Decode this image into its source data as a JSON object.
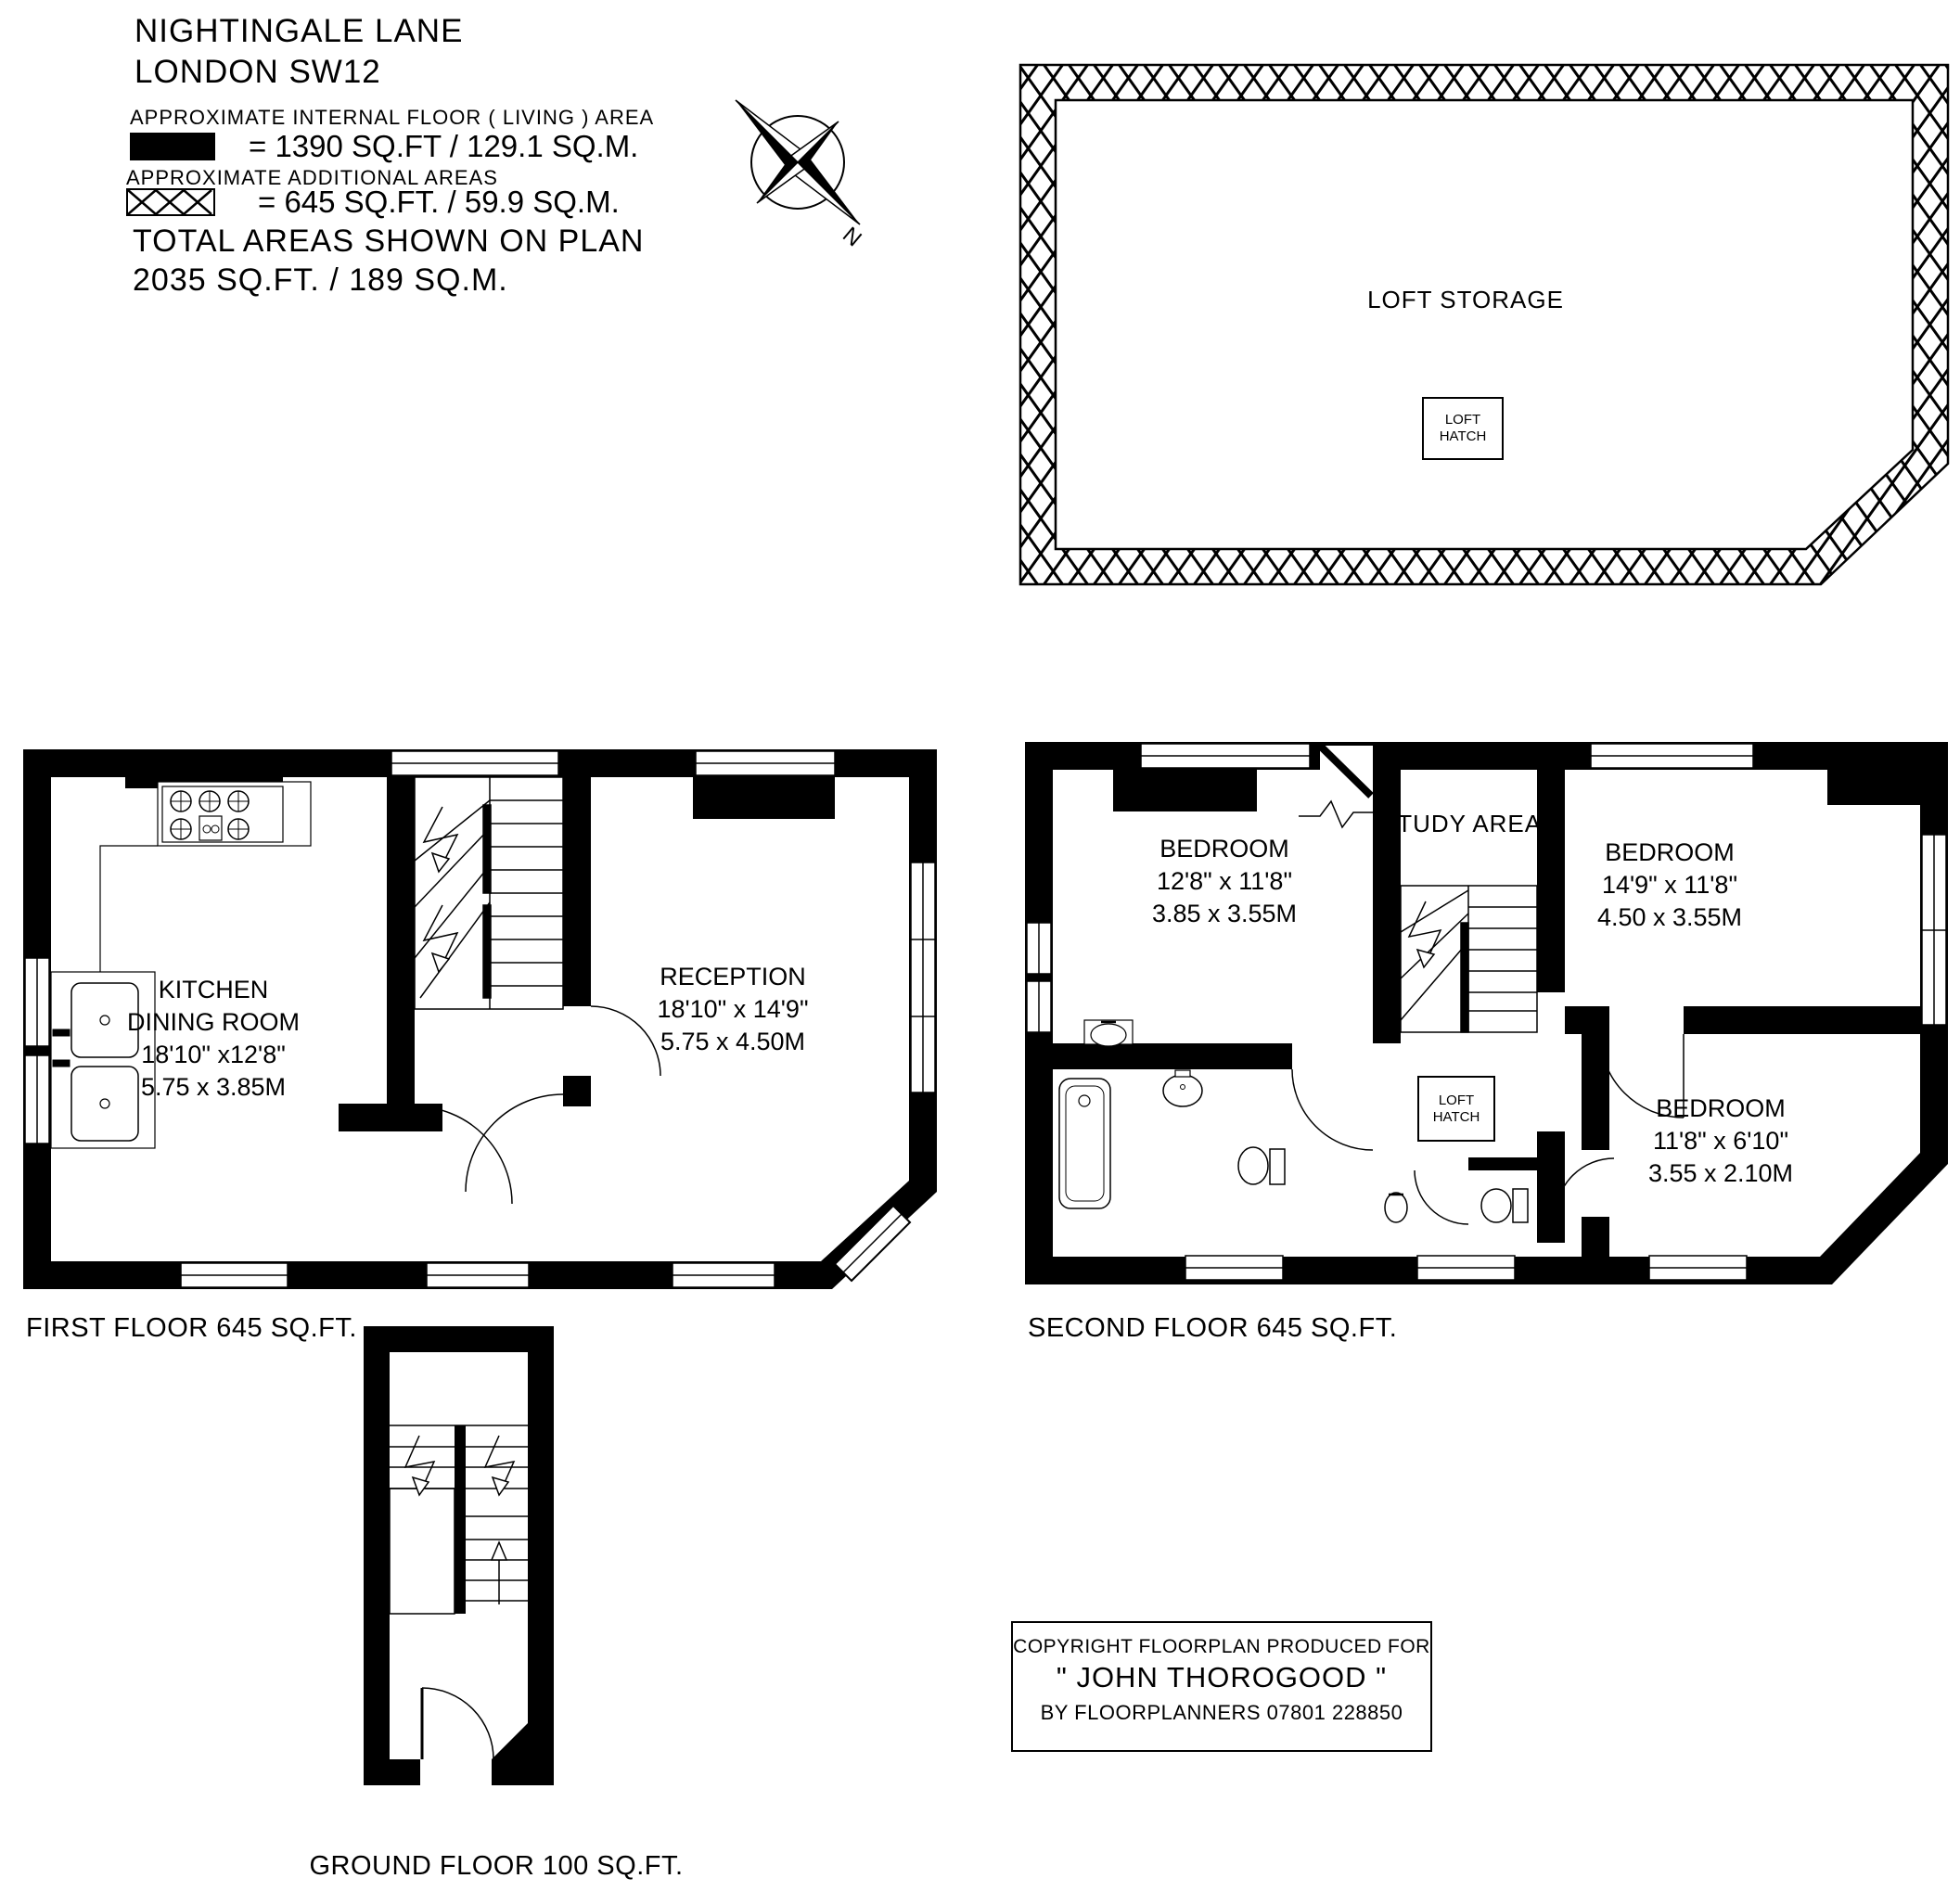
{
  "page": {
    "paper": "#ffffff",
    "ink": "#000000"
  },
  "header": {
    "title_line1": "NIGHTINGALE LANE",
    "title_line2": "LONDON SW12",
    "living_area_label": "APPROXIMATE INTERNAL FLOOR ( LIVING ) AREA",
    "living_area_value": "= 1390 SQ.FT / 129.1 SQ.M.",
    "additional_area_label": "APPROXIMATE ADDITIONAL AREAS",
    "additional_area_value": "= 645 SQ.FT. / 59.9 SQ.M.",
    "total_line1": "TOTAL AREAS SHOWN ON PLAN",
    "total_line2": "2035 SQ.FT. / 189 SQ.M.",
    "compass_north": "N"
  },
  "loft_plan": {
    "room": "LOFT STORAGE",
    "hatch_line1": "LOFT",
    "hatch_line2": "HATCH"
  },
  "first_floor": {
    "caption": "FIRST FLOOR 645 SQ.FT.",
    "kitchen": [
      "KITCHEN",
      "DINING ROOM",
      "18'10\" x12'8\"",
      "5.75 x 3.85M"
    ],
    "reception": [
      "RECEPTION",
      "18'10\" x 14'9\"",
      "5.75 x 4.50M"
    ]
  },
  "second_floor": {
    "caption": "SECOND FLOOR 645 SQ.FT.",
    "study": "STUDY AREA",
    "bedroom_left": [
      "BEDROOM",
      "12'8\" x 11'8\"",
      "3.85 x 3.55M"
    ],
    "bedroom_right": [
      "BEDROOM",
      "14'9\" x 11'8\"",
      "4.50 x 3.55M"
    ],
    "bedroom_small": [
      "BEDROOM",
      "11'8\" x 6'10\"",
      "3.55 x 2.10M"
    ],
    "hatch_line1": "LOFT",
    "hatch_line2": "HATCH"
  },
  "ground_floor": {
    "caption": "GROUND FLOOR 100 SQ.FT."
  },
  "copyright": {
    "line1": "COPYRIGHT FLOORPLAN PRODUCED FOR",
    "line2": "\" JOHN THOROGOOD \"",
    "line3": "BY FLOORPLANNERS 07801 228850"
  }
}
